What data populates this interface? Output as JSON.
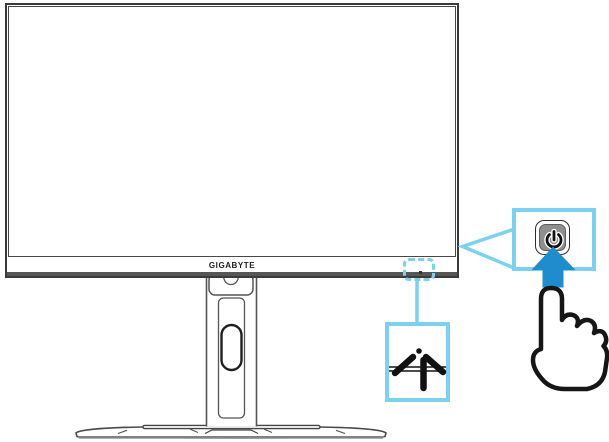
{
  "monitor": {
    "brand_label": "GIGABYTE"
  },
  "callouts": {
    "led_indicator": {
      "icon": "led-indicator-icon",
      "note": ""
    },
    "power_button": {
      "icon": "power-icon"
    },
    "press_arrow": {
      "icon": "arrow-up-icon"
    },
    "hand_cursor": {
      "icon": "pointing-hand-icon"
    }
  },
  "colors": {
    "callout_blue": "#7ED0F1",
    "arrow_blue": "#1E8CCD",
    "button_gray": "#8F8F8F",
    "outline_dark": "#3B3B3B"
  }
}
